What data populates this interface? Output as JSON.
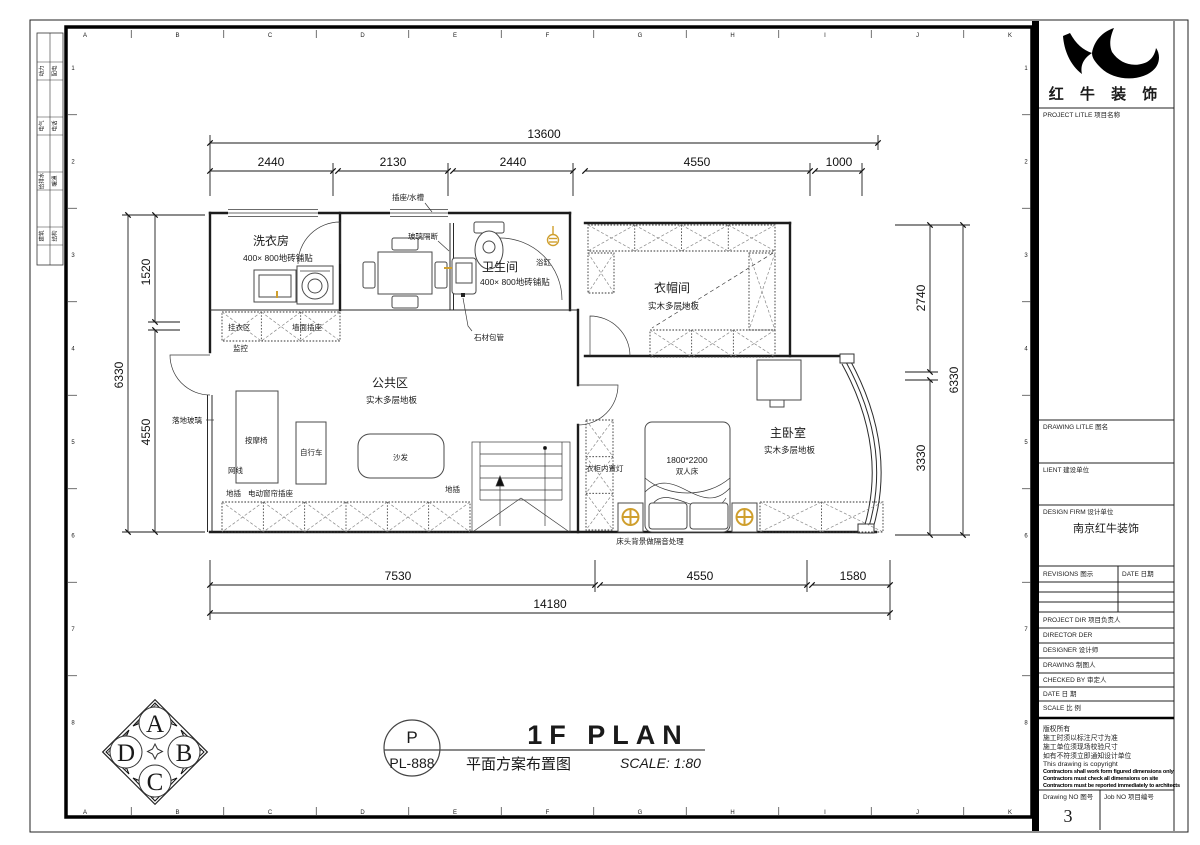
{
  "sheet": {
    "grid_letters": [
      "A",
      "B",
      "C",
      "D",
      "E",
      "F",
      "G",
      "H",
      "I",
      "J",
      "K"
    ],
    "grid_numbers": [
      "1",
      "2",
      "3",
      "4",
      "5",
      "6",
      "7",
      "8"
    ],
    "side_strip": [
      [
        "动力",
        "配电"
      ],
      [
        "电气",
        "电话"
      ],
      [
        "给排水",
        "暖通"
      ],
      [
        "建筑",
        "结构"
      ]
    ]
  },
  "dims": {
    "top_total": "13600",
    "top_segments": [
      "2440",
      "2130",
      "2440",
      "4550",
      "1000"
    ],
    "bottom_segments": [
      "7530",
      "4550",
      "1580"
    ],
    "bottom_total": "14180",
    "left_segments": [
      "1520",
      "4550"
    ],
    "left_total": "6330",
    "right_segments": [
      "2740",
      "3330"
    ],
    "right_total": "6330"
  },
  "rooms": {
    "laundry": {
      "name": "洗衣房",
      "floor": "400× 800地砖铺贴"
    },
    "bathroom": {
      "name": "卫生间",
      "floor": "400× 800地砖铺贴"
    },
    "public": {
      "name": "公共区",
      "floor": "实木多层地板"
    },
    "cloakroom": {
      "name": "衣帽间",
      "floor": "实木多层地板"
    },
    "bedroom": {
      "name": "主卧室",
      "floor": "实木多层地板"
    }
  },
  "labels": {
    "socket_sink": "插座/水槽",
    "glass_partition": "玻璃隔断",
    "bathtub": "浴缸",
    "stone_pipe": "石材包管",
    "hang_area": "挂衣区",
    "wall_socket": "墙面插座",
    "monitor": "监控",
    "floor_glass": "落地玻璃",
    "massage_chair": "按摩椅",
    "bicycle": "自行车",
    "sofa": "沙发",
    "network_cable": "网线",
    "floor_socket": "地插",
    "floor_socket_2": "地插",
    "curtain_socket": "电动窗帘插座",
    "wardrobe_light": "衣柜内置灯",
    "bed_size": "1800*2200",
    "bed_type": "双人床",
    "headboard_note": "床头背景做隔音处理"
  },
  "title": {
    "bubble_letter": "P",
    "bubble_code": "PL-888",
    "name_en": "1F PLAN",
    "name_cn": "平面方案布置图",
    "scale": "SCALE: 1:80"
  },
  "compass": {
    "top": "A",
    "right": "B",
    "bottom": "C",
    "left": "D"
  },
  "titleblock": {
    "company": "红 牛 装 饰",
    "project_label": "PROJECT LITLE  项目名称",
    "drawing_label": "DRAWING LITLE  图名",
    "client_label": "LIENT  建设单位",
    "firm_label": "DESIGN FIRM  设计单位",
    "firm_name": "南京红牛装饰",
    "revisions_label": "REVISIONS  图示",
    "revisions_date_label": "DATE  日期",
    "project_dir_label": "PROJECT DIR    项目负责人",
    "director_label": "DIRECTOR DER",
    "designer_label": "DESIGNER       设计师",
    "drawing_by_label": "DRAWING       制图人",
    "checked_label": "CHECKED BY    审定人",
    "date_label": "DATE              日  期",
    "scale_label": "SCALE             比  例",
    "notes_cn": [
      "版权所有",
      "施工时须以标注尺寸为准",
      "施工单位须现场校验尺寸",
      "如有不符须立即通知设计单位"
    ],
    "notes_en": [
      "This drawing is copyright",
      "Contractors shall work form figured dimensions only",
      "Contractors must check all dimensions on site",
      "Contractors must be reported immediately to architects"
    ],
    "drawing_no_label": "Drawing NO  图号",
    "drawing_no": "3",
    "job_no_label": "Job NO  项目编号"
  }
}
